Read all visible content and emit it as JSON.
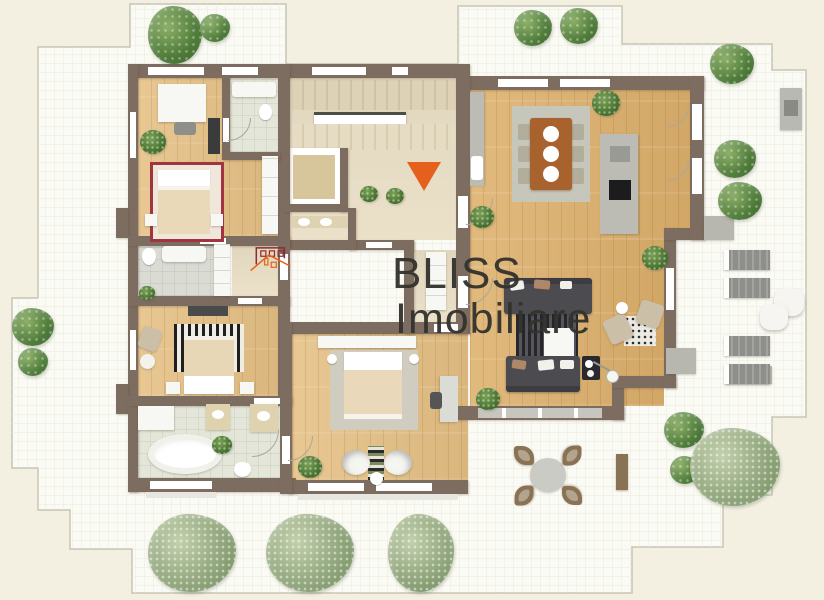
{
  "watermark": {
    "brand_line1": "BLISS",
    "brand_line2": "Imobiliare"
  },
  "colors": {
    "background": "#f3f0e1",
    "terrace": "#fbfbf5",
    "boundary_line": "#c7c4b4",
    "wall": "#7d6d60",
    "wall_light": "#8d7d6f",
    "wood": "#ddb06c",
    "wood_light": "#e5c084",
    "hall_floor": "#eadfc6",
    "elevator_floor": "#d7c59b",
    "tile_green": "#e3e6d8",
    "tile_gray": "#dadbd3",
    "rug_gray": "#d0ccc0",
    "sofa": "#4b4b50",
    "table_brown": "#a8622d",
    "counter_gray": "#bcbcb4",
    "tree": "#527c3d",
    "tree_light": "#9cb284",
    "accent_orange": "#e6601d",
    "logo_maroon": "#8e2b33",
    "text_dark": "#34332e",
    "lounger": "#8e8e8a",
    "chair_brown": "#8a7355"
  },
  "plan": {
    "type": "apartment-floor-plan-top-view",
    "entrance_marker": "orange-triangle-arrow",
    "rooms": [
      "bedroom-1",
      "ensuite-bathroom",
      "staircase",
      "elevator",
      "hallway",
      "guest-bathroom",
      "bedroom-2",
      "bathroom-3",
      "bedroom-3",
      "main-bathroom",
      "dining-kitchen",
      "living-room",
      "corridor",
      "wrap-around-terrace"
    ],
    "outdoor_items": [
      "sun-loungers-x4",
      "poufs-x2",
      "round-table-with-4-chairs",
      "bench",
      "grill",
      "trees",
      "bushes"
    ]
  }
}
